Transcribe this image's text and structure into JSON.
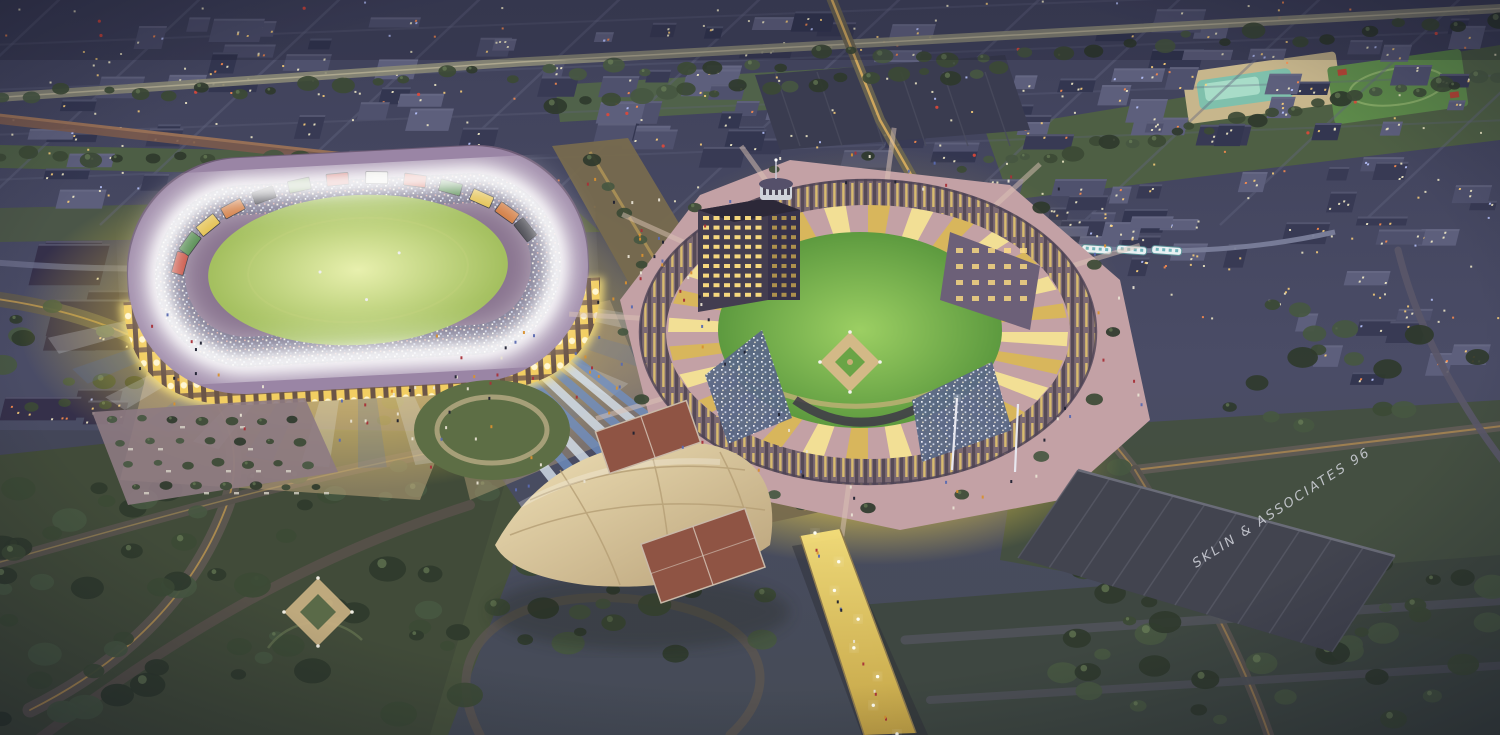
{
  "artwork": {
    "signature": "SKLIN & ASSOCIATES 96"
  },
  "palette": {
    "night_top": "#3f415a",
    "night_base": "#4a4c66",
    "block_dark": "#383a54",
    "block_mid": "#4f516d",
    "block_light": "#5d5f7c",
    "block_deep": "#333650",
    "window_warm": "#f3ecc8",
    "window_gold": "#ffd27a",
    "window_orange": "#ff8d4d",
    "window_blue": "#b9c4ff",
    "accent_red": "#e04838",
    "tree_dark": "#2f3a2c",
    "tree_mid": "#3c4a35",
    "tree_soft": "#465741",
    "tree_hi": "#6f855c",
    "park_band": "#4e5f44",
    "park_big": "#47523c",
    "road_dark": "#5b564f",
    "road_light": "#8a8876",
    "road_amber": "#caa050",
    "glow_gold": "#f7d84a",
    "glow_pale": "#fff7c0",
    "halo_white": "#ffffff",
    "stadium_wall": "#8a7590",
    "stadium_roof": "#9a85a5",
    "arcade_gold": "#f2ce62",
    "field_left_hi": "#e8f0ae",
    "field_left": "#a3bf5e",
    "field_right_hi": "#9ccf63",
    "field_right": "#5d9a3f",
    "infield_tan": "#d3b987",
    "plaza_pink": "#c3a1a5",
    "plaza_path": "#dcc4b6",
    "ramp_blue": "#6f8fc0",
    "ramp_pale": "#d7e2ee",
    "court_red": "#8f5444",
    "canopy_hi": "#efe0b6",
    "canopy_lo": "#b9a27a",
    "tower_face": "#433d50",
    "tower_side": "#37324a",
    "tower_window": "#ffdf82",
    "warehouse": "#42444f",
    "bridge_hi": "#f7e07a",
    "bridge_lo": "#caa845",
    "signature_ink": "#d4d6de"
  }
}
